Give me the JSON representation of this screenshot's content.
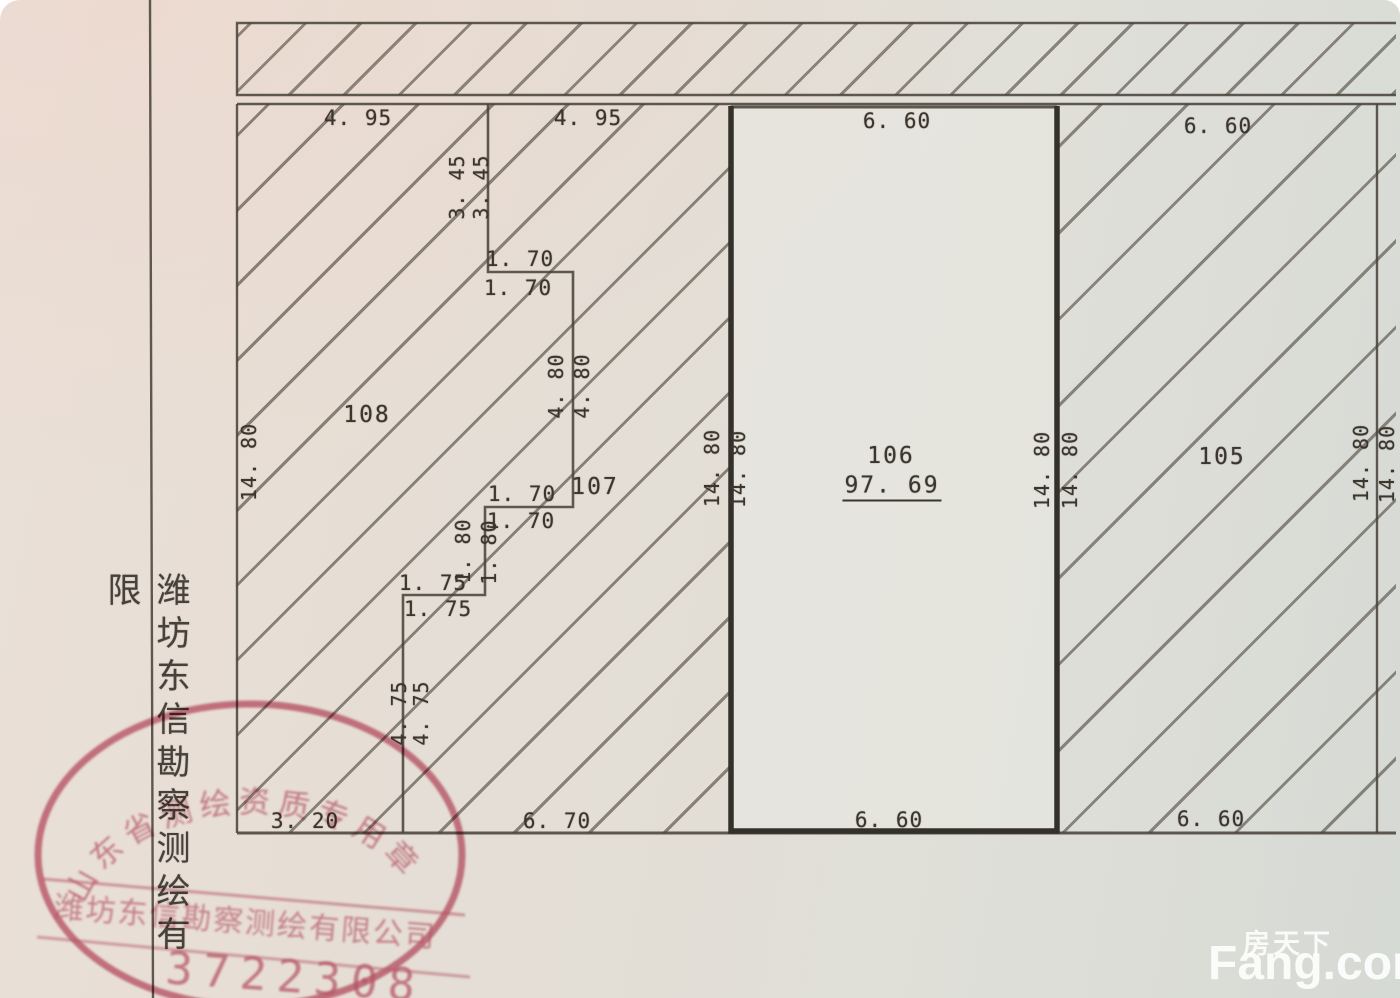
{
  "side_label": "潍坊东信勘察测绘有限",
  "stamp": {
    "arc_text": "山东省测绘资质专用章",
    "company_line": "潍坊东信勘察测绘有限公司",
    "serial": "3722308"
  },
  "watermark": {
    "cn": "房天下",
    "en": "Fang.com"
  },
  "parcels": {
    "p108": {
      "id": "108"
    },
    "p107": {
      "id": "107"
    },
    "p106": {
      "id": "106",
      "area": "97. 69"
    },
    "p105": {
      "id": "105"
    }
  },
  "dims": [
    "4. 95",
    "4. 95",
    "6. 60",
    "6. 60",
    "1. 70",
    "1. 70",
    "1. 70",
    "1. 70",
    "1. 75",
    "1. 75",
    "3. 20",
    "6. 70",
    "6. 60",
    "6. 60",
    "3. 45",
    "3. 45",
    "4. 80",
    "4. 80",
    "1. 80",
    "1. 80",
    "4. 75",
    "4. 75",
    "14. 80",
    "14. 80",
    "14. 80",
    "14. 80",
    "14. 80",
    "14. 80",
    "14. 80"
  ]
}
